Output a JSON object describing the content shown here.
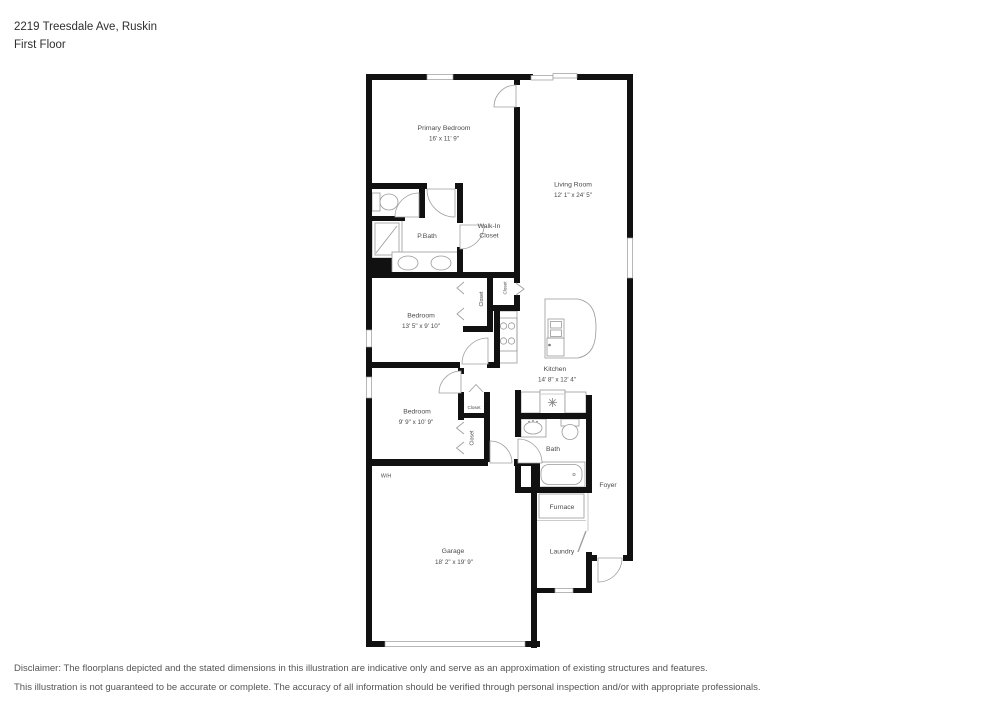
{
  "header": {
    "address": "2219 Treesdale Ave, Ruskin",
    "floor": "First Floor"
  },
  "plan": {
    "rooms": {
      "primary_bedroom": {
        "name": "Primary Bedroom",
        "dims": "16' x 11' 9\""
      },
      "living_room": {
        "name": "Living Room",
        "dims": "12' 1\" x 24' 5\""
      },
      "p_bath": {
        "name": "P.Bath"
      },
      "walk_in_closet": {
        "name_line1": "Walk-In",
        "name_line2": "Closet"
      },
      "bedroom_2": {
        "name": "Bedroom",
        "dims": "13' 5\" x 9' 10\""
      },
      "bedroom_3": {
        "name": "Bedroom",
        "dims": "9' 9\" x 10' 9\""
      },
      "kitchen": {
        "name": "Kitchen",
        "dims": "14' 8\" x 12' 4\""
      },
      "bath": {
        "name": "Bath"
      },
      "foyer": {
        "name": "Foyer"
      },
      "furnace": {
        "name": "Furnace"
      },
      "laundry": {
        "name": "Laundry"
      },
      "garage": {
        "name": "Garage",
        "dims": "18' 2\" x 19' 9\""
      },
      "water_heater": {
        "name": "W/H"
      },
      "closet_bedroom2": {
        "name": "Closet"
      },
      "closet_pantry": {
        "name": "Closet"
      },
      "closet_hall": {
        "name": "Closet"
      },
      "closet_bedroom3": {
        "name": "Closet"
      }
    }
  },
  "disclaimer": {
    "line1": "Disclaimer: The floorplans depicted and the stated dimensions in this illustration are indicative only and serve as an approximation of existing structures and features.",
    "line2": "This illustration is not guaranteed to be accurate or complete. The accuracy of all information should be verified through personal inspection and/or with appropriate professionals."
  },
  "colors": {
    "wall": "#111111",
    "label_text": "#4a4a4a",
    "fixture_line": "#999999",
    "header_text": "#2f2f2f",
    "disclaimer_text": "#555555"
  }
}
